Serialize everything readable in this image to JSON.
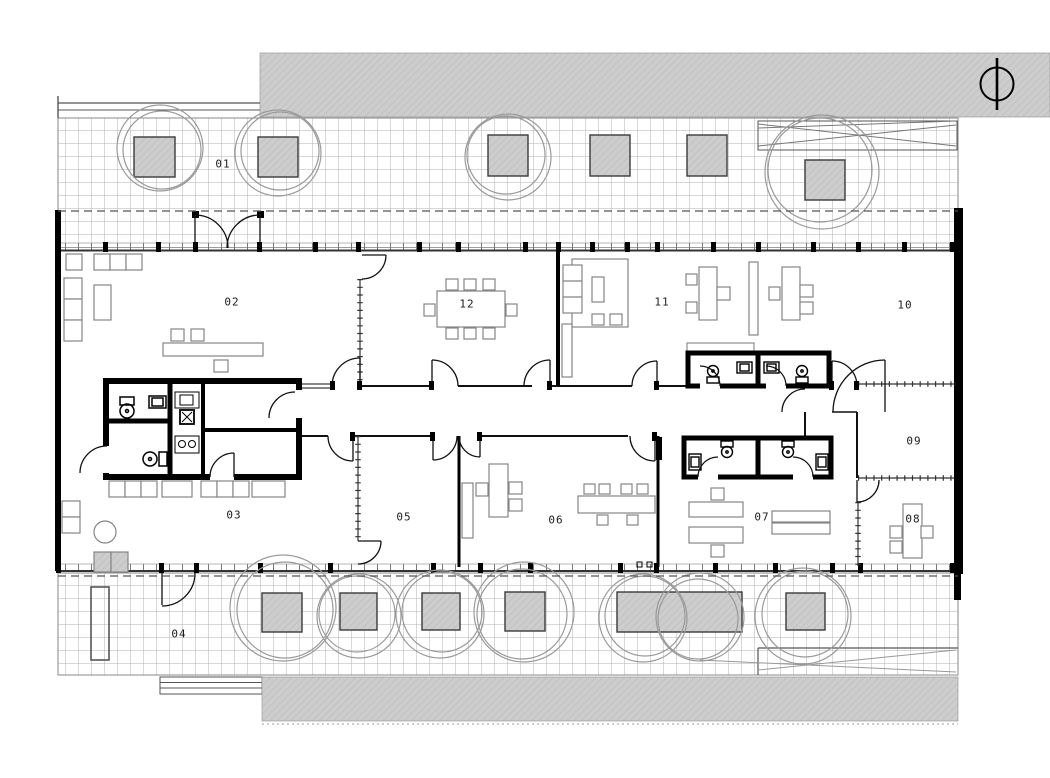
{
  "plan": {
    "title": "office floor plan",
    "rooms": [
      {
        "label": "01"
      },
      {
        "label": "02"
      },
      {
        "label": "03"
      },
      {
        "label": "04"
      },
      {
        "label": "05"
      },
      {
        "label": "06"
      },
      {
        "label": "07"
      },
      {
        "label": "08"
      },
      {
        "label": "09"
      },
      {
        "label": "10"
      },
      {
        "label": "11"
      },
      {
        "label": "12"
      }
    ],
    "icons": {
      "north_arrow": "north-arrow-icon",
      "toilet": "toilet-icon",
      "sink": "sink-icon",
      "tree": "tree-icon",
      "planter": "planter-icon"
    },
    "colors": {
      "wall": "#000000",
      "partition": "#222222",
      "paving_gray": "#cdcdcd",
      "grid_line": "#b2b2b2",
      "furniture": "#858585",
      "tree": "#9a9a9a",
      "dashed_line": "#555555"
    }
  }
}
